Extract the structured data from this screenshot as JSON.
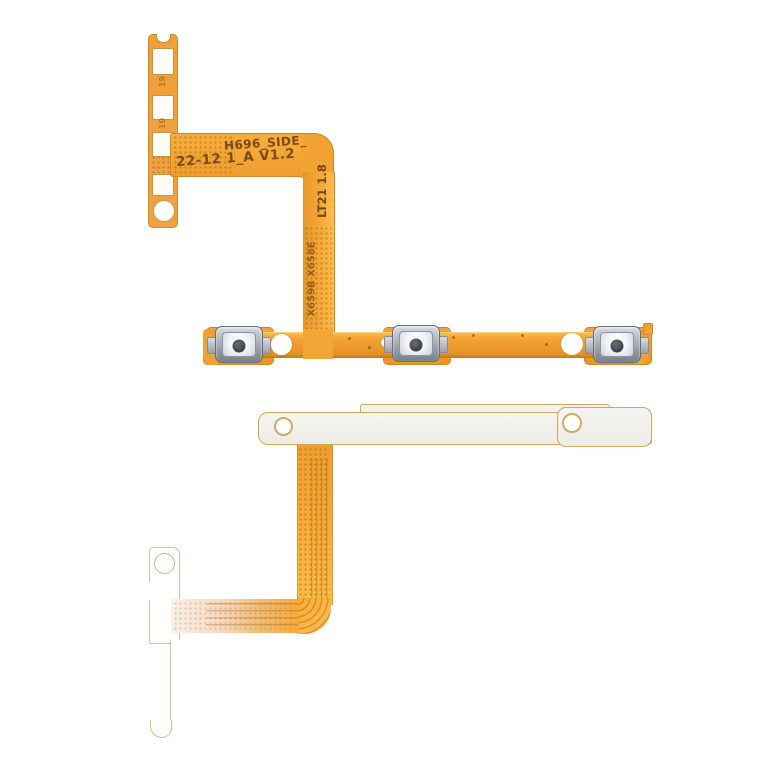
{
  "subject": "phone side-key (power and volume) flex cable product photo",
  "markings": {
    "line1": "H696_SIDE_",
    "line2": "22-12 1_A V1.2",
    "vertical1": "LT21 1.8",
    "vertical2": "X659B X658E",
    "pad_mark1": "19",
    "pad_mark2": "10"
  },
  "colors": {
    "background": "#ffffff",
    "flex_orange": "#f2a233",
    "flex_orange_deep": "#e08e1f",
    "flex_highlight": "#ffc14e",
    "marking_text": "#7c4a10",
    "metal_button_frame": "#9298a2",
    "metal_button_face": "#eef1f6",
    "metal_button_dot": "#3d414a",
    "bracket_fill": "#f2f1ed",
    "bracket_outline": "#cfa95e"
  },
  "components": {
    "button_count": 3
  }
}
